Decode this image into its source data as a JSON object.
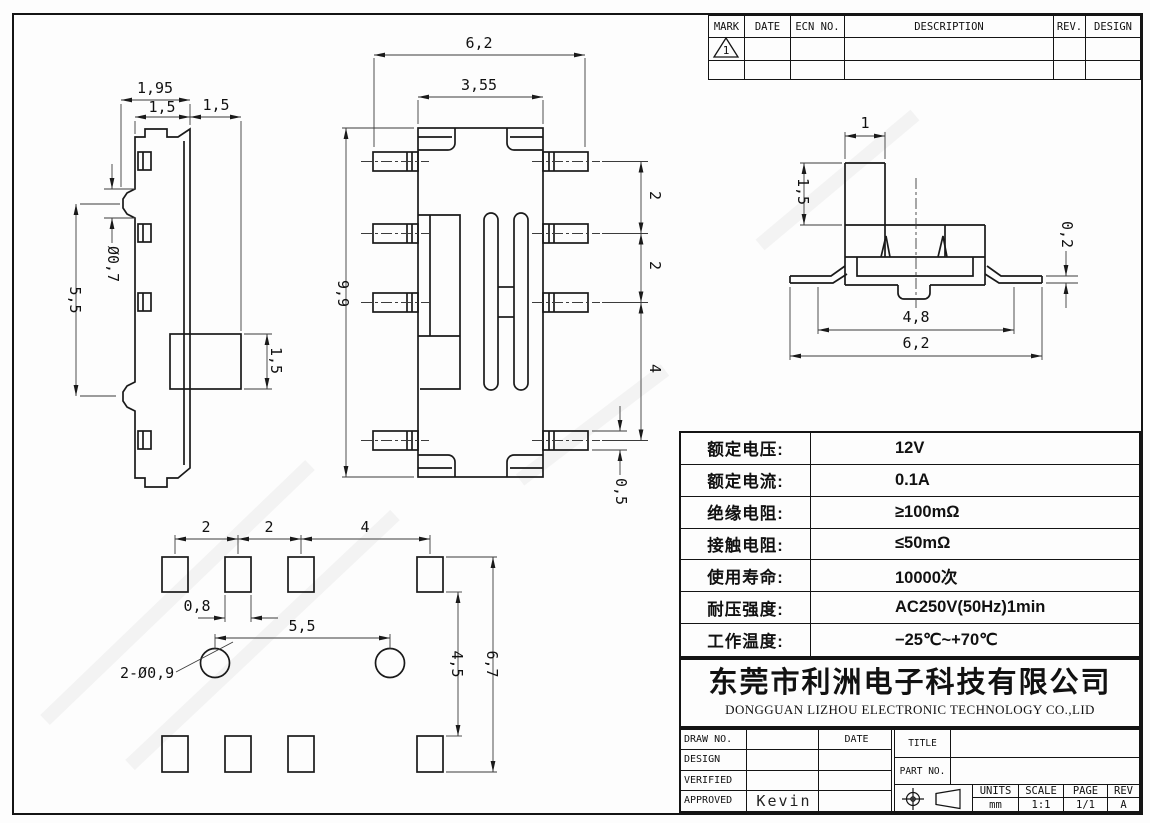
{
  "revision_table": {
    "headers": [
      "MARK",
      "DATE",
      "ECN NO.",
      "DESCRIPTION",
      "REV.",
      "DESIGN"
    ],
    "mark1": "1"
  },
  "specs": {
    "rows": [
      {
        "label": "额定电压:",
        "value": "12V"
      },
      {
        "label": "额定电流:",
        "value": "0.1A"
      },
      {
        "label": "绝缘电阻:",
        "value": "≥100mΩ"
      },
      {
        "label": "接触电阻:",
        "value": "≤50mΩ"
      },
      {
        "label": "使用寿命:",
        "value": "10000次"
      },
      {
        "label": "耐压强度:",
        "value": "AC250V(50Hz)1min"
      },
      {
        "label": "工作温度:",
        "value": "−25℃~+70℃"
      }
    ]
  },
  "company": {
    "cn": "东莞市利洲电子科技有限公司",
    "en": "DONGGUAN LIZHOU ELECTRONIC TECHNOLOGY CO.,LID"
  },
  "footer": {
    "draw_no": "DRAW NO.",
    "date": "DATE",
    "design": "DESIGN",
    "verified": "VERIFIED",
    "approved": "APPROVED",
    "approved_by": "Kevin",
    "title": "TITLE",
    "part_no": "PART NO.",
    "units": "UNITS",
    "scale": "SCALE",
    "page": "PAGE",
    "rev": "REV",
    "units_v": "mm",
    "scale_v": "1:1",
    "page_v": "1/1",
    "rev_v": "A"
  },
  "dims": {
    "side": [
      "1,95",
      "1,5",
      "1,5",
      "Ø0,7",
      "5,5",
      "1,5"
    ],
    "front": [
      "6,2",
      "3,55",
      "9,9",
      "2",
      "2",
      "4",
      "0,5"
    ],
    "right": [
      "1",
      "1,5",
      "0,2",
      "4,8",
      "6,2"
    ],
    "pattern": [
      "2",
      "2",
      "4",
      "0,8",
      "5,5",
      "2-Ø0,9",
      "4,5",
      "6,7"
    ]
  }
}
